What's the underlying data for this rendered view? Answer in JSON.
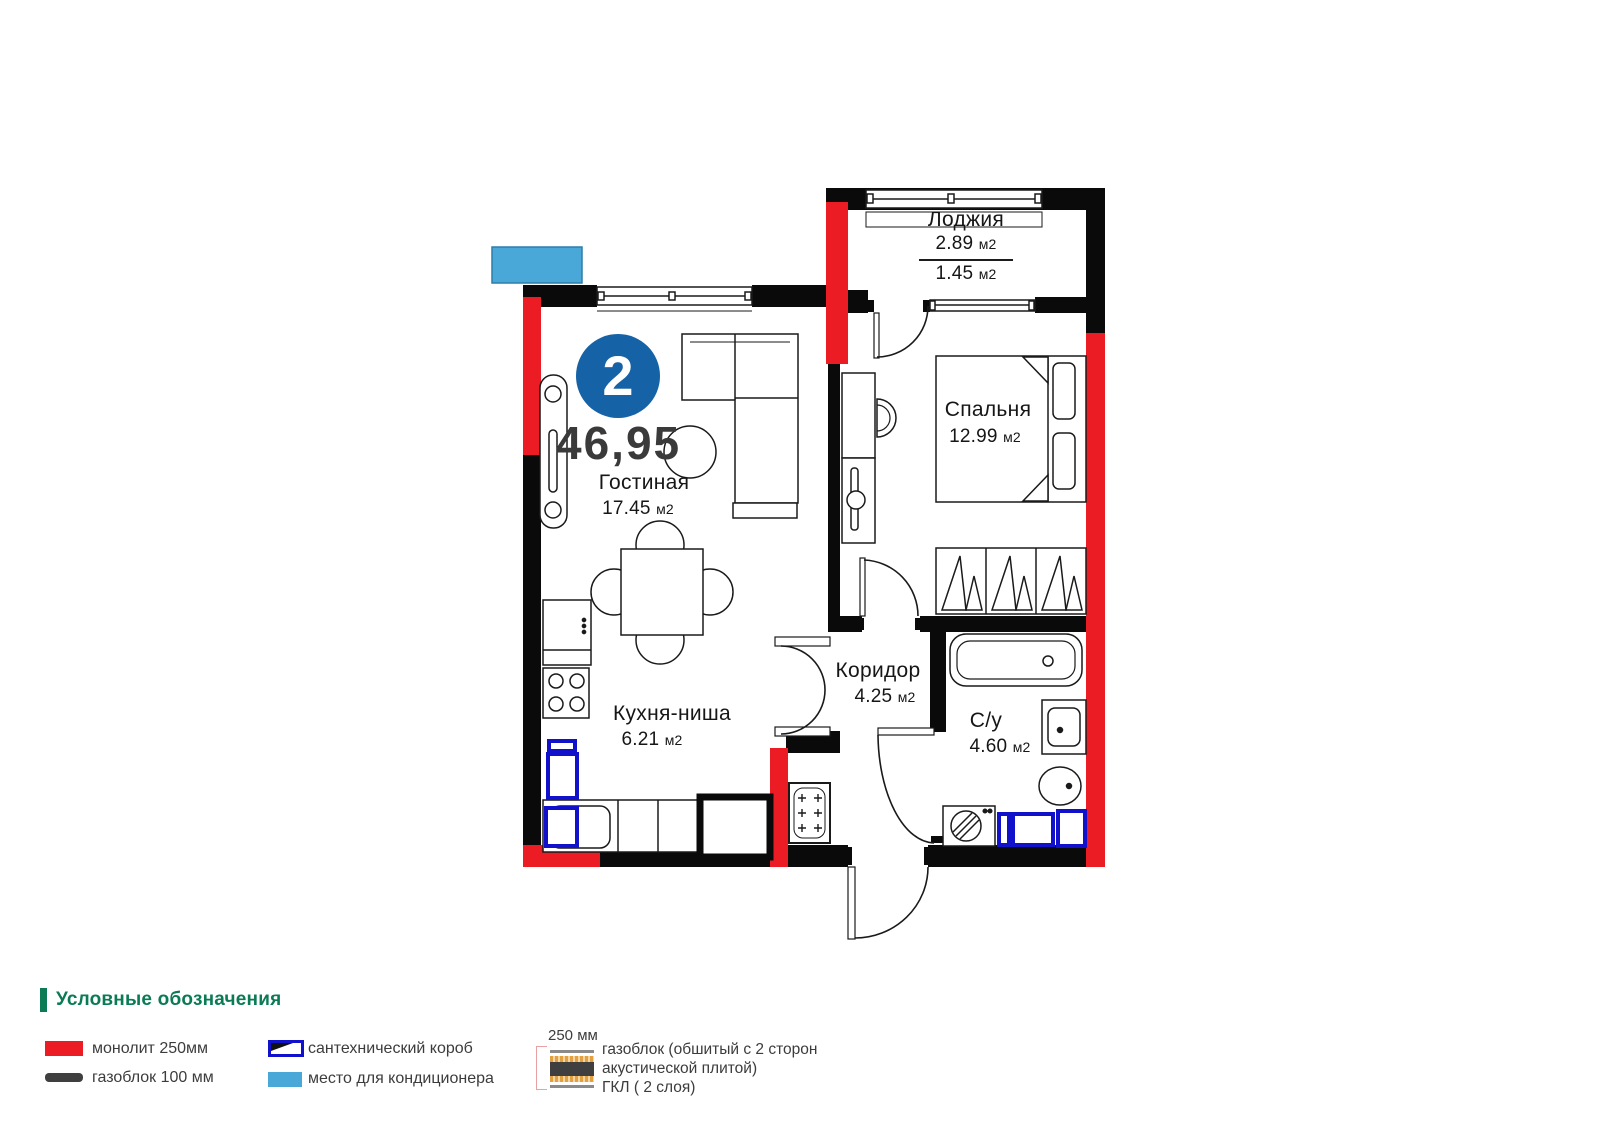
{
  "unit": {
    "number": "2",
    "total_area": "46,95"
  },
  "units": {
    "m2": "м2"
  },
  "rooms": {
    "loggia": {
      "name": "Лоджия",
      "area_full": "2.89",
      "area_coef": "1.45"
    },
    "bedroom": {
      "name": "Спальня",
      "area": "12.99"
    },
    "living": {
      "name": "Гостиная",
      "area": "17.45"
    },
    "kitchen": {
      "name": "Кухня-ниша",
      "area": "6.21"
    },
    "corridor": {
      "name": "Коридор",
      "area": "4.25"
    },
    "bathroom": {
      "name": "С/у",
      "area": "4.60"
    }
  },
  "legend": {
    "title": "Условные обозначения",
    "monolith": "монолит 250мм",
    "gasblock": "газоблок 100 мм",
    "plumbing_box": "сантехнический короб",
    "ac_place": "место для кондиционера",
    "gkl_size": "250 мм",
    "gkl_lines": [
      "газоблок (обшитый с 2 сторон",
      "акустической плитой)",
      "ГКЛ ( 2 слоя)"
    ]
  },
  "colors": {
    "monolith_red": "#ec1c24",
    "wall_black": "#0a0a0a",
    "badge_blue": "#1562a7",
    "ac_blue": "#49a8d8",
    "plumbing_blue": "#1111cc",
    "legend_green": "#0a7b54",
    "text_dark": "#161616"
  }
}
